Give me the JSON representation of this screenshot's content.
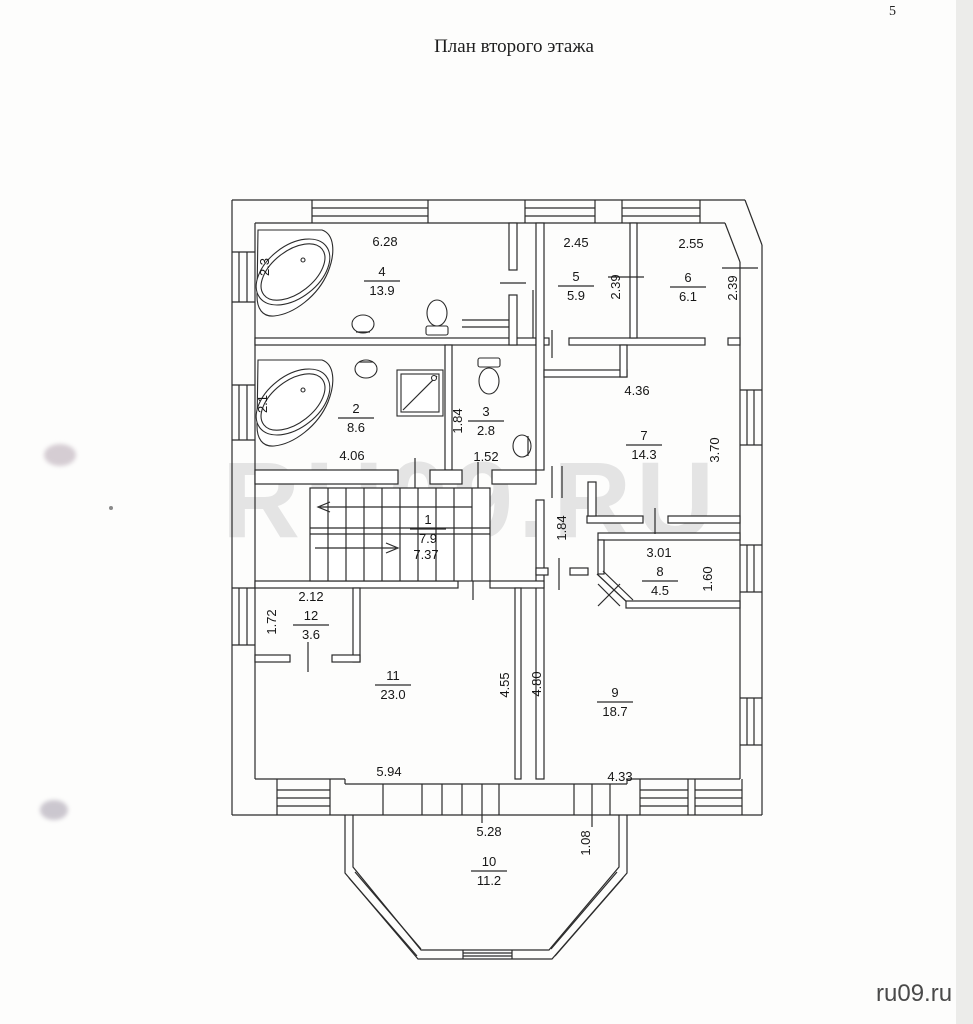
{
  "page": {
    "number": "5",
    "title": "План второго этажа",
    "watermark": "RU09.RU",
    "footer": "ru09.ru"
  },
  "colors": {
    "line": "#2b2b2b",
    "watermark": "#e4e4e4",
    "footer_text": "#4a4a4a",
    "paper": "#fdfdfc",
    "scan_edge": "#ececea"
  },
  "rooms": [
    {
      "number": "1",
      "area": "7.9"
    },
    {
      "number": "2",
      "area": "8.6"
    },
    {
      "number": "3",
      "area": "2.8"
    },
    {
      "number": "4",
      "area": "13.9"
    },
    {
      "number": "5",
      "area": "5.9"
    },
    {
      "number": "6",
      "area": "6.1"
    },
    {
      "number": "7",
      "area": "14.3"
    },
    {
      "number": "8",
      "area": "4.5"
    },
    {
      "number": "9",
      "area": "18.7"
    },
    {
      "number": "10",
      "area": "11.2"
    },
    {
      "number": "11",
      "area": "23.0"
    },
    {
      "number": "12",
      "area": "3.6"
    }
  ],
  "dims": [
    "6.28",
    "2.45",
    "2.55",
    "2.39",
    "2.39",
    "2.3",
    "4.06",
    "1.84",
    "1.52",
    "4.36",
    "3.70",
    "7.37",
    "1.84",
    "3.01",
    "1.60",
    "2.12",
    "1.72",
    "4.55",
    "4.80",
    "5.94",
    "4.33",
    "5.28",
    "1.08",
    "2.1"
  ]
}
